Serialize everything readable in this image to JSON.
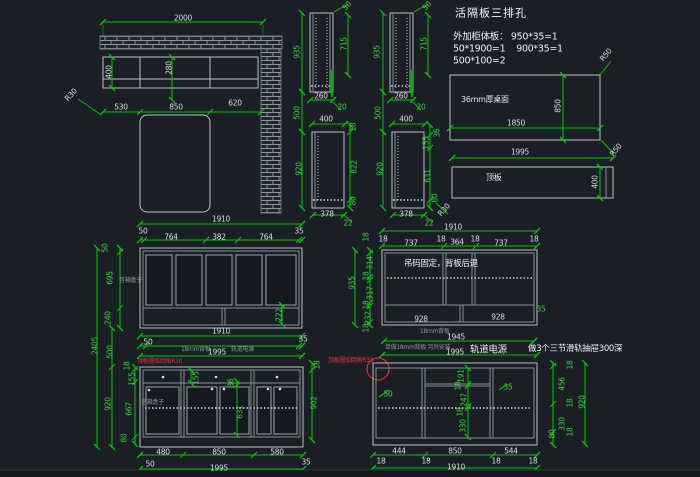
{
  "app": {
    "canvas": "cad-drawing",
    "background": "#1a1f26"
  },
  "colors": {
    "dim_line": "#00c400",
    "dim_text_green": "#35d435",
    "dim_text_white": "#d9dde2",
    "outline": "#b9bfc6",
    "annotation_red": "#e23535",
    "annotation_gray": "#8d949b",
    "hatch": "#949ba3"
  },
  "notes": {
    "title": "活隔板三排孔",
    "line1": "外加柜体板： 950*35=1",
    "line2": "50*1900=1    900*35=1",
    "line3": "500*100=2",
    "desk_top": "36mm厚桌面",
    "top_board": "顶板",
    "hanging": "吊码固定，背板后退",
    "rail_power": "轨道电源",
    "drawers": "做3个三节滑轨抽屉300深",
    "back_panel": "18mm背板",
    "back_panel2": "单做18mm背板 另外安装",
    "red_note": "顶板圆弧倒角R30",
    "box_note": "音箱盒子"
  },
  "labels": [
    {
      "t": "2000",
      "x": 183,
      "y": 18
    },
    {
      "t": "400",
      "x": 109,
      "y": 72,
      "r": -90
    },
    {
      "t": "280",
      "x": 169,
      "y": 68,
      "r": -90
    },
    {
      "t": "R30",
      "x": 71,
      "y": 95,
      "r": -48
    },
    {
      "t": "530",
      "x": 121,
      "y": 107
    },
    {
      "t": "850",
      "x": 176,
      "y": 107
    },
    {
      "t": "620",
      "x": 235,
      "y": 103
    },
    {
      "t": "1910",
      "x": 221,
      "y": 219
    },
    {
      "t": "935",
      "x": 297,
      "y": 52,
      "r": -90,
      "c": "dg"
    },
    {
      "t": "50",
      "x": 347,
      "y": 6,
      "r": -48,
      "c": "dg"
    },
    {
      "t": "715",
      "x": 344,
      "y": 44,
      "r": -90,
      "c": "dg"
    },
    {
      "t": "260",
      "x": 321,
      "y": 96
    },
    {
      "t": "20",
      "x": 342,
      "y": 107,
      "c": "dg"
    },
    {
      "t": "500",
      "x": 297,
      "y": 113,
      "r": -90,
      "c": "dg"
    },
    {
      "t": "400",
      "x": 326,
      "y": 119
    },
    {
      "t": "18",
      "x": 353,
      "y": 127,
      "r": -90,
      "c": "dg"
    },
    {
      "t": "822",
      "x": 354,
      "y": 167,
      "r": -90,
      "c": "dg"
    },
    {
      "t": "80",
      "x": 353,
      "y": 201,
      "r": -90,
      "c": "dg"
    },
    {
      "t": "920",
      "x": 299,
      "y": 169,
      "r": -90,
      "c": "dg"
    },
    {
      "t": "378",
      "x": 327,
      "y": 214
    },
    {
      "t": "22",
      "x": 348,
      "y": 223,
      "c": "dg"
    },
    {
      "t": "935",
      "x": 377,
      "y": 52,
      "r": -90,
      "c": "dg"
    },
    {
      "t": "50",
      "x": 427,
      "y": 6,
      "r": -48,
      "c": "dg"
    },
    {
      "t": "715",
      "x": 424,
      "y": 44,
      "r": -90,
      "c": "dg"
    },
    {
      "t": "260",
      "x": 401,
      "y": 96
    },
    {
      "t": "20",
      "x": 421,
      "y": 107,
      "c": "dg"
    },
    {
      "t": "500",
      "x": 378,
      "y": 113,
      "r": -90,
      "c": "dg"
    },
    {
      "t": "400",
      "x": 406,
      "y": 119
    },
    {
      "t": "36",
      "x": 437,
      "y": 133,
      "r": -90,
      "c": "dg"
    },
    {
      "t": "155",
      "x": 426,
      "y": 143,
      "r": -90,
      "c": "dg"
    },
    {
      "t": "631",
      "x": 428,
      "y": 176,
      "r": -90,
      "c": "dg"
    },
    {
      "t": "80",
      "x": 435,
      "y": 198,
      "r": -90,
      "c": "dg"
    },
    {
      "t": "R30",
      "x": 444,
      "y": 210,
      "r": -48
    },
    {
      "t": "378",
      "x": 406,
      "y": 214
    },
    {
      "t": "22",
      "x": 429,
      "y": 223,
      "c": "dg"
    },
    {
      "t": "920",
      "x": 380,
      "y": 169,
      "r": -90,
      "c": "dg"
    },
    {
      "t": "活隔板三排孔",
      "x": 455,
      "y": 13,
      "c": "cn11",
      "a": "l"
    },
    {
      "t": "外加柜体板： 950*35=1",
      "x": 453,
      "y": 37,
      "c": "cn10",
      "a": "l"
    },
    {
      "t": "50*1900=1    900*35=1",
      "x": 453,
      "y": 49,
      "c": "cn10",
      "a": "l"
    },
    {
      "t": "500*100=2",
      "x": 453,
      "y": 61,
      "c": "cn10",
      "a": "l"
    },
    {
      "t": "R50",
      "x": 606,
      "y": 55,
      "r": -50
    },
    {
      "t": "36mm厚桌面",
      "x": 461,
      "y": 100,
      "c": "cn8",
      "a": "l"
    },
    {
      "t": "850",
      "x": 558,
      "y": 106,
      "r": -90
    },
    {
      "t": "1850",
      "x": 516,
      "y": 123
    },
    {
      "t": "R50",
      "x": 616,
      "y": 150,
      "r": -50
    },
    {
      "t": "1995",
      "x": 520,
      "y": 152
    },
    {
      "t": "顶板",
      "x": 486,
      "y": 178,
      "c": "cn8",
      "a": "l"
    },
    {
      "t": "400",
      "x": 595,
      "y": 182,
      "r": -90
    },
    {
      "t": "1910",
      "x": 453,
      "y": 227
    },
    {
      "t": "18",
      "x": 383,
      "y": 239
    },
    {
      "t": "737",
      "x": 411,
      "y": 243
    },
    {
      "t": "18",
      "x": 441,
      "y": 239
    },
    {
      "t": "364",
      "x": 457,
      "y": 242
    },
    {
      "t": "18",
      "x": 475,
      "y": 239
    },
    {
      "t": "737",
      "x": 501,
      "y": 243
    },
    {
      "t": "18",
      "x": 534,
      "y": 239
    },
    {
      "t": "935",
      "x": 352,
      "y": 283,
      "r": -90,
      "c": "dg"
    },
    {
      "t": "18",
      "x": 366,
      "y": 237,
      "r": -90,
      "c": "dg"
    },
    {
      "t": "314",
      "x": 370,
      "y": 263,
      "r": -90,
      "c": "dg"
    },
    {
      "t": "18",
      "x": 366,
      "y": 276,
      "r": -90,
      "c": "dg"
    },
    {
      "t": "317",
      "x": 370,
      "y": 293,
      "r": -90,
      "c": "dg"
    },
    {
      "t": "18",
      "x": 366,
      "y": 305,
      "r": -90,
      "c": "dg"
    },
    {
      "t": "232",
      "x": 368,
      "y": 318,
      "r": -90,
      "c": "dg"
    },
    {
      "t": "18",
      "x": 366,
      "y": 328,
      "r": -90,
      "c": "dg"
    },
    {
      "t": "吊码固定，背板后退",
      "x": 404,
      "y": 264,
      "c": "cn",
      "a": "l"
    },
    {
      "t": "928",
      "x": 421,
      "y": 319
    },
    {
      "t": "928",
      "x": 498,
      "y": 317
    },
    {
      "t": "35",
      "x": 541,
      "y": 309,
      "c": "dg"
    },
    {
      "t": "1945",
      "x": 456,
      "y": 337
    },
    {
      "t": "18mm背板",
      "x": 420,
      "y": 332,
      "c": "t",
      "a": "l"
    },
    {
      "t": "单做18mm背板 另外安装",
      "x": 385,
      "y": 348,
      "c": "t",
      "a": "l"
    },
    {
      "t": "1995",
      "x": 455,
      "y": 352
    },
    {
      "t": "轨道电源",
      "x": 470,
      "y": 350,
      "c": "cn10",
      "a": "l"
    },
    {
      "t": "做3个三节滑轨抽屉300深",
      "x": 528,
      "y": 349,
      "c": "cn",
      "a": "l"
    },
    {
      "t": "顶板圆弧倒角R30",
      "x": 328,
      "y": 361,
      "c": "r",
      "a": "l"
    },
    {
      "t": "50",
      "x": 388,
      "y": 394,
      "c": "dg"
    },
    {
      "t": "191",
      "x": 461,
      "y": 376,
      "r": -90,
      "c": "dg"
    },
    {
      "t": "18",
      "x": 458,
      "y": 386,
      "r": -90,
      "c": "dg"
    },
    {
      "t": "247",
      "x": 464,
      "y": 400,
      "r": -90,
      "c": "dg"
    },
    {
      "t": "18",
      "x": 460,
      "y": 412,
      "r": -90,
      "c": "dg"
    },
    {
      "t": "330",
      "x": 463,
      "y": 426,
      "r": -90,
      "c": "dg"
    },
    {
      "t": "35",
      "x": 508,
      "y": 387,
      "c": "dg"
    },
    {
      "t": "18",
      "x": 570,
      "y": 365,
      "r": -90,
      "c": "dg"
    },
    {
      "t": "456",
      "x": 562,
      "y": 384,
      "r": -90,
      "c": "dg"
    },
    {
      "t": "18",
      "x": 570,
      "y": 403,
      "r": -90,
      "c": "dg"
    },
    {
      "t": "330",
      "x": 562,
      "y": 424,
      "r": -90,
      "c": "dg"
    },
    {
      "t": "18",
      "x": 570,
      "y": 432,
      "r": -90,
      "c": "dg"
    },
    {
      "t": "80",
      "x": 552,
      "y": 434,
      "r": -90,
      "c": "dg"
    },
    {
      "t": "920",
      "x": 582,
      "y": 402,
      "r": -90,
      "c": "dg"
    },
    {
      "t": "444",
      "x": 399,
      "y": 451
    },
    {
      "t": "850",
      "x": 455,
      "y": 451
    },
    {
      "t": "544",
      "x": 511,
      "y": 451
    },
    {
      "t": "18",
      "x": 381,
      "y": 461
    },
    {
      "t": "18",
      "x": 426,
      "y": 461
    },
    {
      "t": "18",
      "x": 496,
      "y": 461
    },
    {
      "t": "18",
      "x": 533,
      "y": 461
    },
    {
      "t": "1910",
      "x": 456,
      "y": 467
    },
    {
      "t": "50",
      "x": 143,
      "y": 231
    },
    {
      "t": "764",
      "x": 171,
      "y": 237
    },
    {
      "t": "382",
      "x": 219,
      "y": 237
    },
    {
      "t": "764",
      "x": 266,
      "y": 237
    },
    {
      "t": "35",
      "x": 299,
      "y": 231
    },
    {
      "t": "50",
      "x": 105,
      "y": 248,
      "r": -90,
      "c": "dg"
    },
    {
      "t": "695",
      "x": 110,
      "y": 278,
      "r": -90,
      "c": "dg"
    },
    {
      "t": "240",
      "x": 108,
      "y": 318,
      "r": -90,
      "c": "dg"
    },
    {
      "t": "2405",
      "x": 95,
      "y": 346,
      "r": -90,
      "c": "dg"
    },
    {
      "t": "500",
      "x": 110,
      "y": 352,
      "r": -90,
      "c": "dg"
    },
    {
      "t": "222",
      "x": 279,
      "y": 315,
      "r": -90,
      "c": "dg"
    },
    {
      "t": "音箱盒子",
      "x": 119,
      "y": 281,
      "c": "t",
      "a": "l"
    },
    {
      "t": "1910",
      "x": 221,
      "y": 331
    },
    {
      "t": "50",
      "x": 148,
      "y": 342
    },
    {
      "t": "35",
      "x": 303,
      "y": 339
    },
    {
      "t": "18mm背板",
      "x": 181,
      "y": 350,
      "c": "t",
      "a": "l"
    },
    {
      "t": "1995",
      "x": 217,
      "y": 352
    },
    {
      "t": "轨道电源",
      "x": 231,
      "y": 350,
      "c": "t",
      "a": "l"
    },
    {
      "t": "顶板圆弧倒角R30",
      "x": 137,
      "y": 362,
      "c": "r",
      "a": "l"
    },
    {
      "t": "18",
      "x": 127,
      "y": 366,
      "r": -90,
      "c": "dg"
    },
    {
      "t": "155",
      "x": 132,
      "y": 379,
      "r": -90,
      "c": "dg"
    },
    {
      "t": "667",
      "x": 129,
      "y": 409,
      "r": -90,
      "c": "dg"
    },
    {
      "t": "80",
      "x": 124,
      "y": 438,
      "r": -90,
      "c": "dg"
    },
    {
      "t": "920",
      "x": 108,
      "y": 404,
      "r": -90,
      "c": "dg"
    },
    {
      "t": "155",
      "x": 196,
      "y": 378,
      "r": -90,
      "c": "dg"
    },
    {
      "t": "36",
      "x": 231,
      "y": 383,
      "r": -90,
      "c": "dg"
    },
    {
      "t": "631",
      "x": 240,
      "y": 412,
      "r": -90,
      "c": "dg"
    },
    {
      "t": "902",
      "x": 314,
      "y": 403,
      "r": -90,
      "c": "dg"
    },
    {
      "t": "18",
      "x": 317,
      "y": 365,
      "r": -90,
      "c": "dg"
    },
    {
      "t": "音箱盒子",
      "x": 141,
      "y": 403,
      "c": "t",
      "a": "l"
    },
    {
      "t": "480",
      "x": 163,
      "y": 452
    },
    {
      "t": "850",
      "x": 219,
      "y": 452
    },
    {
      "t": "580",
      "x": 277,
      "y": 452
    },
    {
      "t": "50",
      "x": 150,
      "y": 464
    },
    {
      "t": "1995",
      "x": 219,
      "y": 468
    },
    {
      "t": "35",
      "x": 306,
      "y": 462
    }
  ]
}
